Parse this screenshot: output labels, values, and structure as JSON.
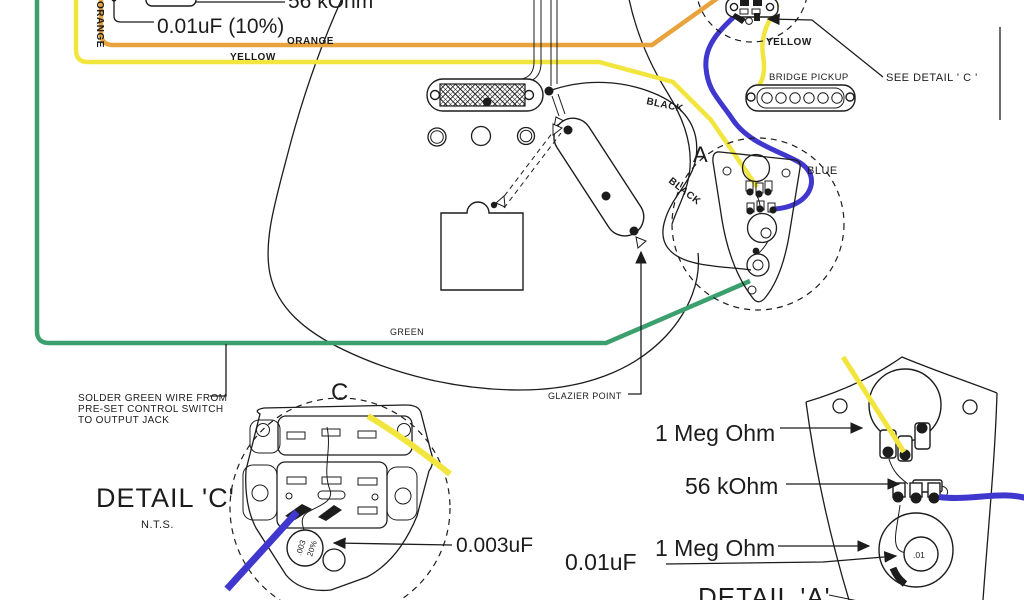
{
  "diagram": {
    "subject": "Electric guitar (offset / Jaguar style) wiring diagram",
    "colors": {
      "orange": "#E8A33C",
      "yellow": "#F2E53E",
      "green": "#3CA06E",
      "blue": "#4038CE",
      "ink": "#1c1c1c"
    },
    "top_left": {
      "resistor_value": "56 kOhm",
      "cap_value": "0.01uF  (10%)"
    },
    "wire_labels": {
      "orange_vertical": "ORANGE",
      "orange": "ORANGE",
      "yellow": "YELLOW",
      "yellow_right": "YELLOW",
      "green": "GREEN",
      "blue": "BLUE",
      "black_1": "BLACK",
      "black_2": "BLACK"
    },
    "bridge_pickup_label": "BRIDGE PICKUP",
    "see_detail_c": "SEE DETAIL ' C '",
    "marker_a": "A",
    "glazier_point": "GLAZIER POINT",
    "solder_note": {
      "line1": "SOLDER GREEN WIRE FROM",
      "line2": "PRE-SET CONTROL SWITCH",
      "line3": "TO OUTPUT JACK"
    },
    "detail_c": {
      "marker": "C",
      "title": "DETAIL 'C'",
      "scale": "N.T.S.",
      "cap_callout": "0.003uF",
      "cap_marking_value": ".003",
      "cap_marking_tolerance": "20%"
    },
    "detail_a": {
      "title": "DETAIL 'A'",
      "pot_top": "1 Meg Ohm",
      "resistor": "56 kOhm",
      "pot_bottom": "1 Meg Ohm",
      "cap_callout": "0.01uF",
      "cap_marking": ".01"
    }
  }
}
